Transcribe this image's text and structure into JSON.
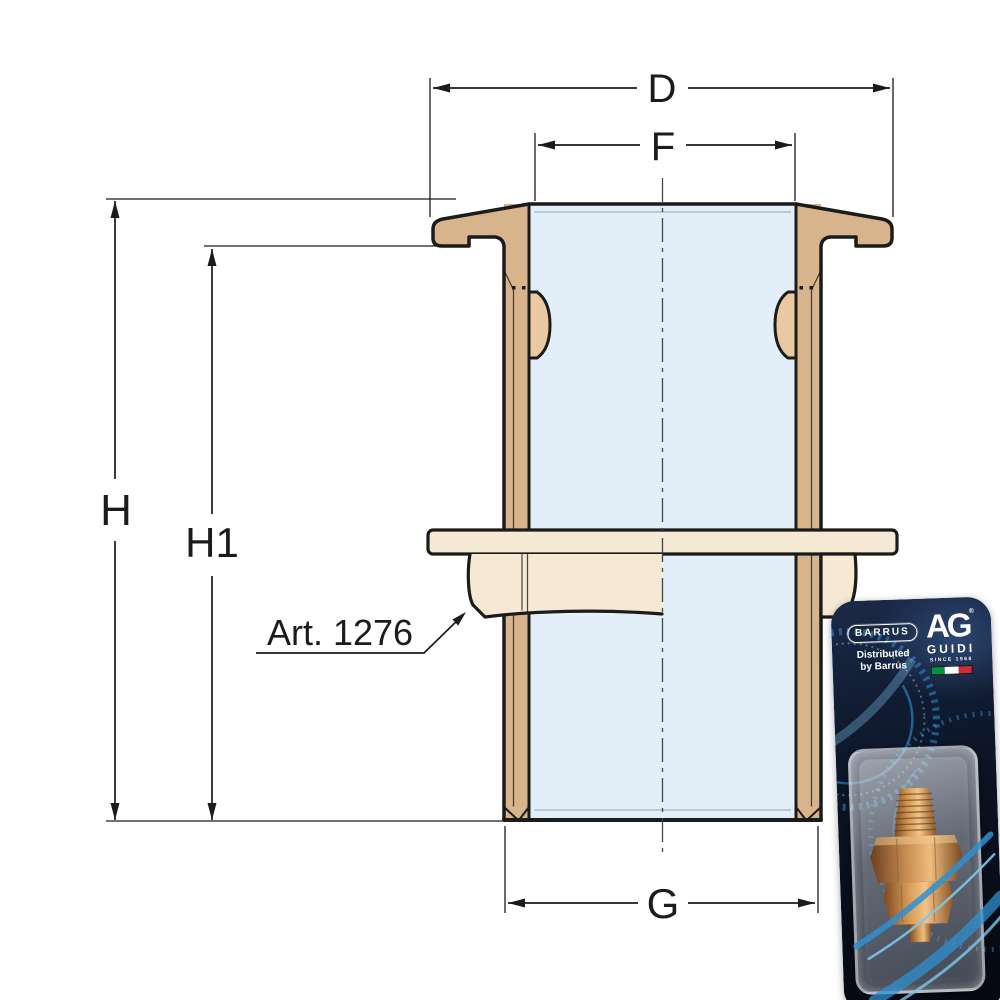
{
  "drawing": {
    "labels": {
      "d": "D",
      "f": "F",
      "h": "H",
      "h1": "H1",
      "g": "G",
      "part": "Art. 1276"
    },
    "colors": {
      "wall": "#d8b48c",
      "section": "#f5e9d4",
      "lug": "#eac9a2",
      "bore": "#e3eff8",
      "outline": "#1b1b1b",
      "centerline": "#454545",
      "dim": "#1b1b1b"
    }
  },
  "packaging": {
    "distributor_logo": "BARRUS",
    "distributor_note_line1": "Distributed",
    "distributor_note_line2": "by Barrus",
    "brand_monogram": "AG",
    "brand_registered": "®",
    "brand_name": "GUIDI",
    "brand_tagline": "SINCE 1968",
    "flag_colors": [
      "#009246",
      "#ffffff",
      "#ce2b37"
    ],
    "accent_blue": "#2f8fd0",
    "accent_blue_light": "#7cc6ec",
    "bronze": "#c98f52"
  }
}
